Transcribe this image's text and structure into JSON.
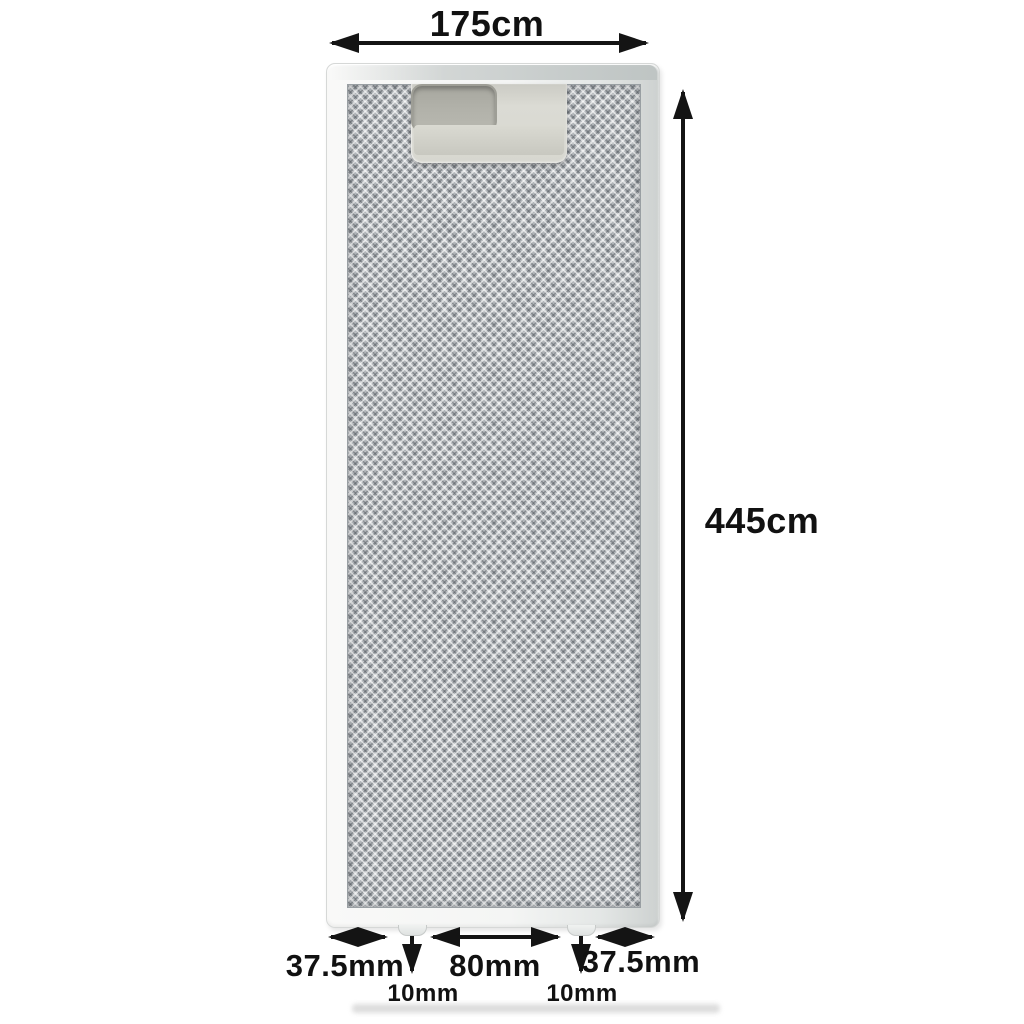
{
  "annotations": {
    "width_label": "175cm",
    "height_label": "445cm",
    "bottom_left_label": "37.5mm",
    "bottom_center_label": "80mm",
    "bottom_right_label": "37.5mm",
    "tab_left_label": "10mm",
    "tab_right_label": "10mm"
  },
  "icons": {
    "arrow_horizontal_top": "double-headed-arrow",
    "arrow_vertical_right": "double-headed-arrow",
    "arrow_bottom_left": "double-headed-arrow",
    "arrow_bottom_center": "double-headed-arrow",
    "arrow_bottom_right": "double-headed-arrow",
    "arrow_tab_left": "down-arrow",
    "arrow_tab_right": "down-arrow"
  },
  "colors": {
    "annotation_ink": "#141414",
    "background": "#ffffff",
    "frame_light": "#f6f6f5",
    "frame_shadow": "#cdd1d0",
    "mesh_base": "#b2b6ba",
    "handle_plate": "#d7d7d0",
    "handle_slot": "#aeaea6"
  }
}
